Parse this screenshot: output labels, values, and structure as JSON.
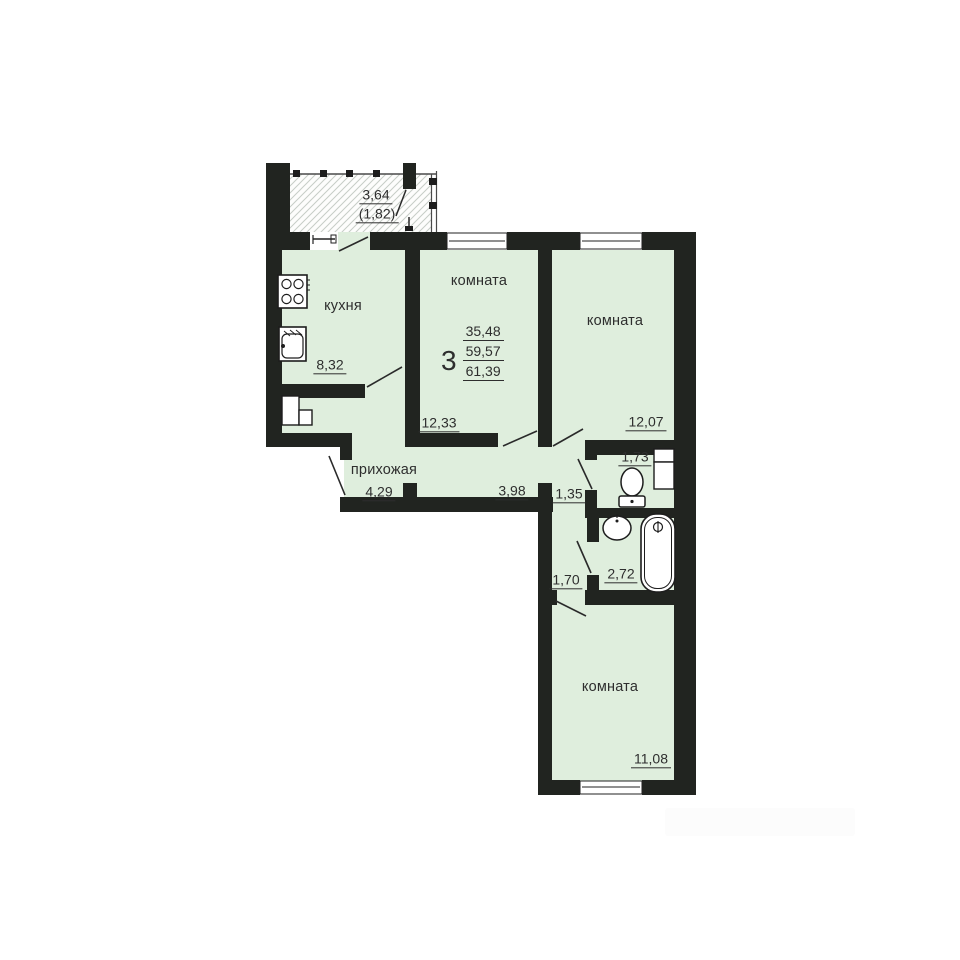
{
  "balcony": {
    "area": "3,64",
    "area_reduced": "(1,82)"
  },
  "rooms": {
    "kitchen": {
      "label": "кухня",
      "area": "8,32"
    },
    "room_mid": {
      "label": "комната",
      "area": "12,33"
    },
    "room_right": {
      "label": "комната",
      "area": "12,07"
    },
    "room_bottom": {
      "label": "комната",
      "area": "11,08"
    }
  },
  "hallway": {
    "label": "прихожая",
    "area": "4,29"
  },
  "corridors": {
    "c398": "3,98",
    "c135": "1,35",
    "c170": "1,70"
  },
  "sanitary": {
    "wc_area": "1,73",
    "bath_area": "2,72"
  },
  "summary": {
    "rooms_count": "3",
    "living_area": "35,48",
    "total_area": "59,57",
    "total_with_balcony": "61,39"
  },
  "colors": {
    "wall": "#212420",
    "room_fill": "#dfeedd",
    "hatch_line": "#c6ccc6",
    "text": "#2e2e2e"
  }
}
